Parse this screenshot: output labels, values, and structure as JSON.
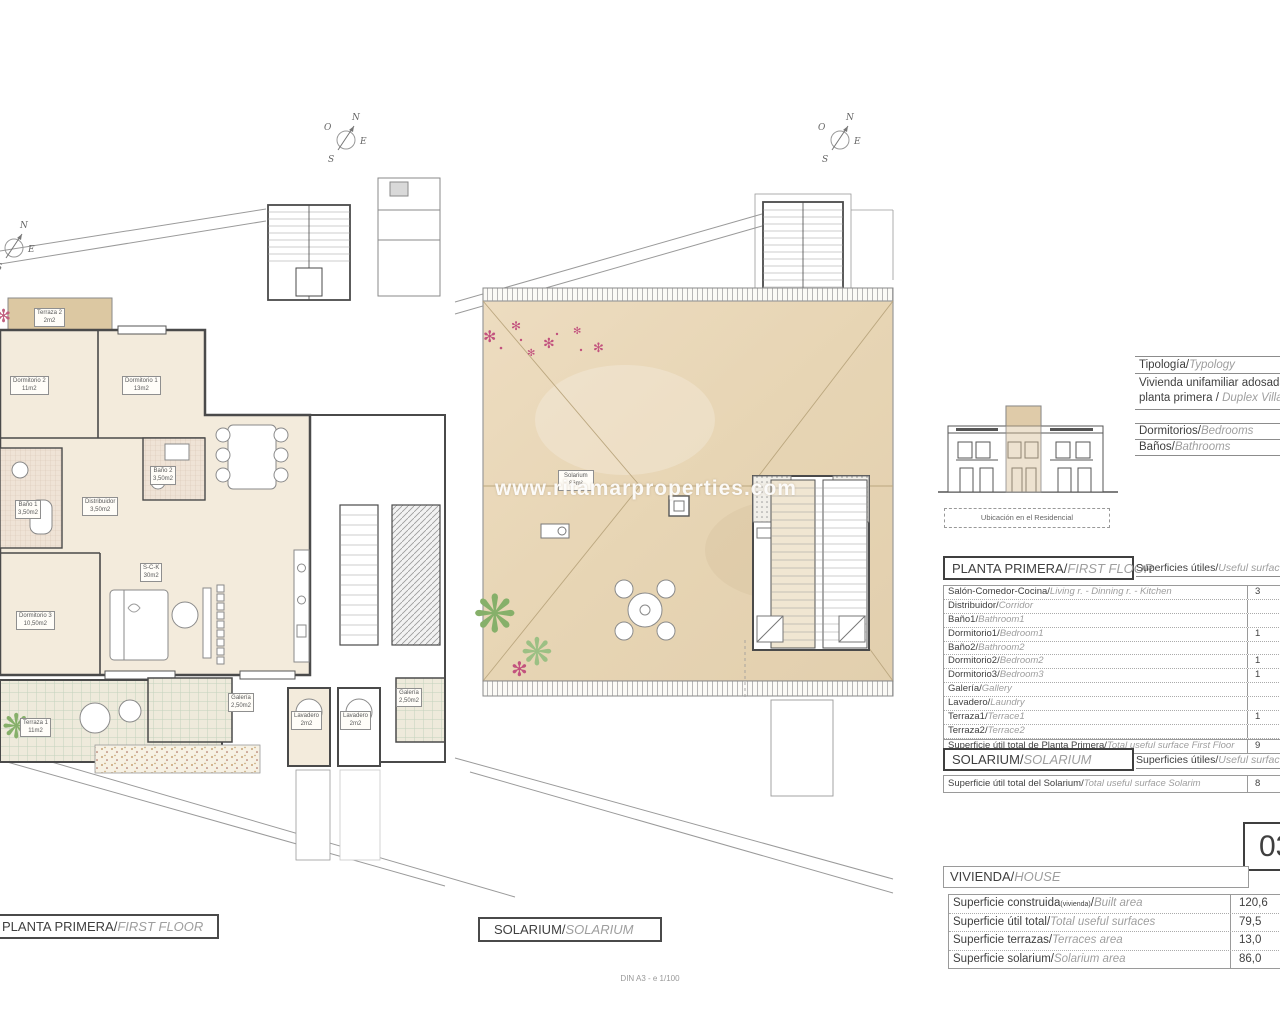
{
  "watermark": "www.ritamarproperties.com",
  "scale_note": "DIN A3 - e 1/100",
  "compass": {
    "n": "N",
    "e": "E",
    "s": "S",
    "o": "O"
  },
  "colors": {
    "room_beige": "#f3ebdc",
    "solarium_tan": "#e9d8b8",
    "terrace_tan": "#dcc8a2",
    "palm_green": "#86b06a",
    "flower_pink": "#c2527e",
    "wall": "#4a4a4a"
  },
  "plan_first_floor": {
    "caption_es": "PLANTA PRIMERA/",
    "caption_en": "FIRST FLOOR",
    "rooms": {
      "terraza2": {
        "name": "Terraza 2",
        "area": "2m2"
      },
      "dormitorio2": {
        "name": "Dormitorio 2",
        "area": "11m2"
      },
      "dormitorio1": {
        "name": "Dormitorio 1",
        "area": "13m2"
      },
      "bano2": {
        "name": "Baño 2",
        "area": "3,50m2"
      },
      "bano1": {
        "name": "Baño 1",
        "area": "3,50m2"
      },
      "distribuidor": {
        "name": "Distribuidor",
        "area": "3,50m2"
      },
      "dormitorio3": {
        "name": "Dormitorio 3",
        "area": "10,50m2"
      },
      "sck": {
        "name": "S-C-K",
        "area": "30m2"
      },
      "terraza1": {
        "name": "Terraza 1",
        "area": "11m2"
      },
      "galeria": {
        "name": "Galería",
        "area": "2,50m2"
      },
      "lavadero1": {
        "name": "Lavadero",
        "area": "2m2"
      },
      "lavadero2": {
        "name": "Lavadero",
        "area": "2m2"
      },
      "galeria2": {
        "name": "Galería",
        "area": "2,50m2"
      }
    }
  },
  "plan_solarium": {
    "caption_es": "SOLARIUM/",
    "caption_en": "SOLARIUM",
    "room": {
      "name": "Solarium",
      "area": "86m²"
    }
  },
  "info": {
    "typology_es": "Tipología/",
    "typology_en": "Typology",
    "typology_line1": "Vivienda unifamiliar adosada",
    "typology_line2_es": "planta primera / ",
    "typology_line2_en": "Duplex Villas",
    "bedrooms_es": "Dormitorios/",
    "bedrooms_en": "Bedrooms",
    "bathrooms_es": "Baños/",
    "bathrooms_en": "Bathrooms",
    "location_caption": "Ubicación en el Residencial"
  },
  "planta_table": {
    "title_es": "PLANTA PRIMERA/",
    "title_en": "FIRST FLOOR",
    "header_es": "Superficies útiles/",
    "header_en": "Useful surfaces",
    "rows": [
      {
        "es": "Salón-Comedor-Cocina/",
        "en": "Living r. - Dinning r. - Kitchen",
        "value": "3"
      },
      {
        "es": "Distribuidor/",
        "en": "Corridor",
        "value": ""
      },
      {
        "es": "Baño1/",
        "en": "Bathroom1",
        "value": ""
      },
      {
        "es": "Dormitorio1/",
        "en": "Bedroom1",
        "value": "1"
      },
      {
        "es": "Baño2/",
        "en": "Bathroom2",
        "value": ""
      },
      {
        "es": "Dormitorio2/",
        "en": "Bedroom2",
        "value": "1"
      },
      {
        "es": "Dormitorio3/",
        "en": "Bedroom3",
        "value": "1"
      },
      {
        "es": "Galería/",
        "en": "Gallery",
        "value": ""
      },
      {
        "es": "Lavadero/",
        "en": "Laundry",
        "value": ""
      },
      {
        "es": "Terraza1/",
        "en": "Terrace1",
        "value": "1"
      },
      {
        "es": "Terraza2/",
        "en": "Terrace2",
        "value": ""
      },
      {
        "es": "Superficie útil total de Planta Primera/",
        "en": "Total useful surface First Floor",
        "value": "9"
      }
    ]
  },
  "solarium_table": {
    "title_es": "SOLARIUM/",
    "title_en": "SOLARIUM",
    "header_es": "Superficies útiles/",
    "header_en": "Useful surfaces",
    "total_es": "Superficie útil total del Solarium/",
    "total_en": "Total useful surface Solarim",
    "total_value": "8"
  },
  "unit_number": "03",
  "vivienda": {
    "title_es": "VIVIENDA/",
    "title_en": "HOUSE",
    "rows": [
      {
        "es": "Superficie construida",
        "sub": "(vivienda)",
        "slash": "/",
        "en": "Built area",
        "value": "120,6"
      },
      {
        "es": "Superficie útil total/",
        "sub": "",
        "slash": "",
        "en": "Total useful surfaces",
        "value": "79,5"
      },
      {
        "es": "Superficie terrazas/",
        "sub": "",
        "slash": "",
        "en": "Terraces area",
        "value": "13,0"
      },
      {
        "es": "Superficie solarium/",
        "sub": "",
        "slash": "",
        "en": "Solarium area",
        "value": "86,0"
      }
    ]
  }
}
